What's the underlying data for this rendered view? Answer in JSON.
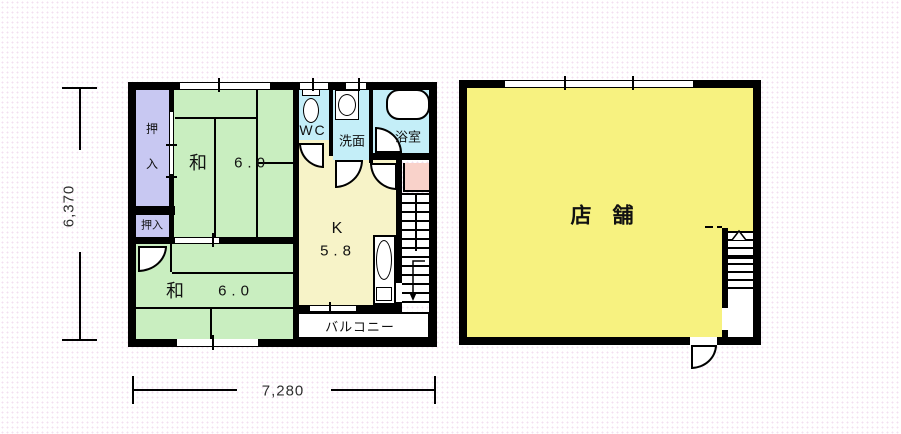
{
  "colors": {
    "wall": "#000000",
    "tatami": "#c9eec0",
    "closet": "#c8c8f2",
    "wet": "#c4eef8",
    "kitchen": "#f7f3c8",
    "shop": "#f7f280",
    "utility": "#f9d2ca",
    "dots": "#f3dff0",
    "text": "#111111",
    "dimtext": "#2f2f2f"
  },
  "plans": {
    "unit": {
      "rooms": {
        "closet_upper": {
          "chars": [
            "押",
            "入"
          ]
        },
        "closet_lower": {
          "label": "押入"
        },
        "tatami_upper": {
          "name": "和",
          "size": "6.0"
        },
        "tatami_lower": {
          "name": "和",
          "size": "6.0"
        },
        "wc": {
          "label": "WC"
        },
        "washroom": {
          "label": "洗面"
        },
        "bathroom": {
          "label": "浴室"
        },
        "kitchen": {
          "name": "K",
          "size": "5.8"
        },
        "balcony": {
          "label": "バルコニー"
        }
      },
      "dimensions": {
        "height": "6,370",
        "width": "7,280"
      }
    },
    "shop": {
      "room": {
        "label": "店　舗"
      }
    }
  }
}
